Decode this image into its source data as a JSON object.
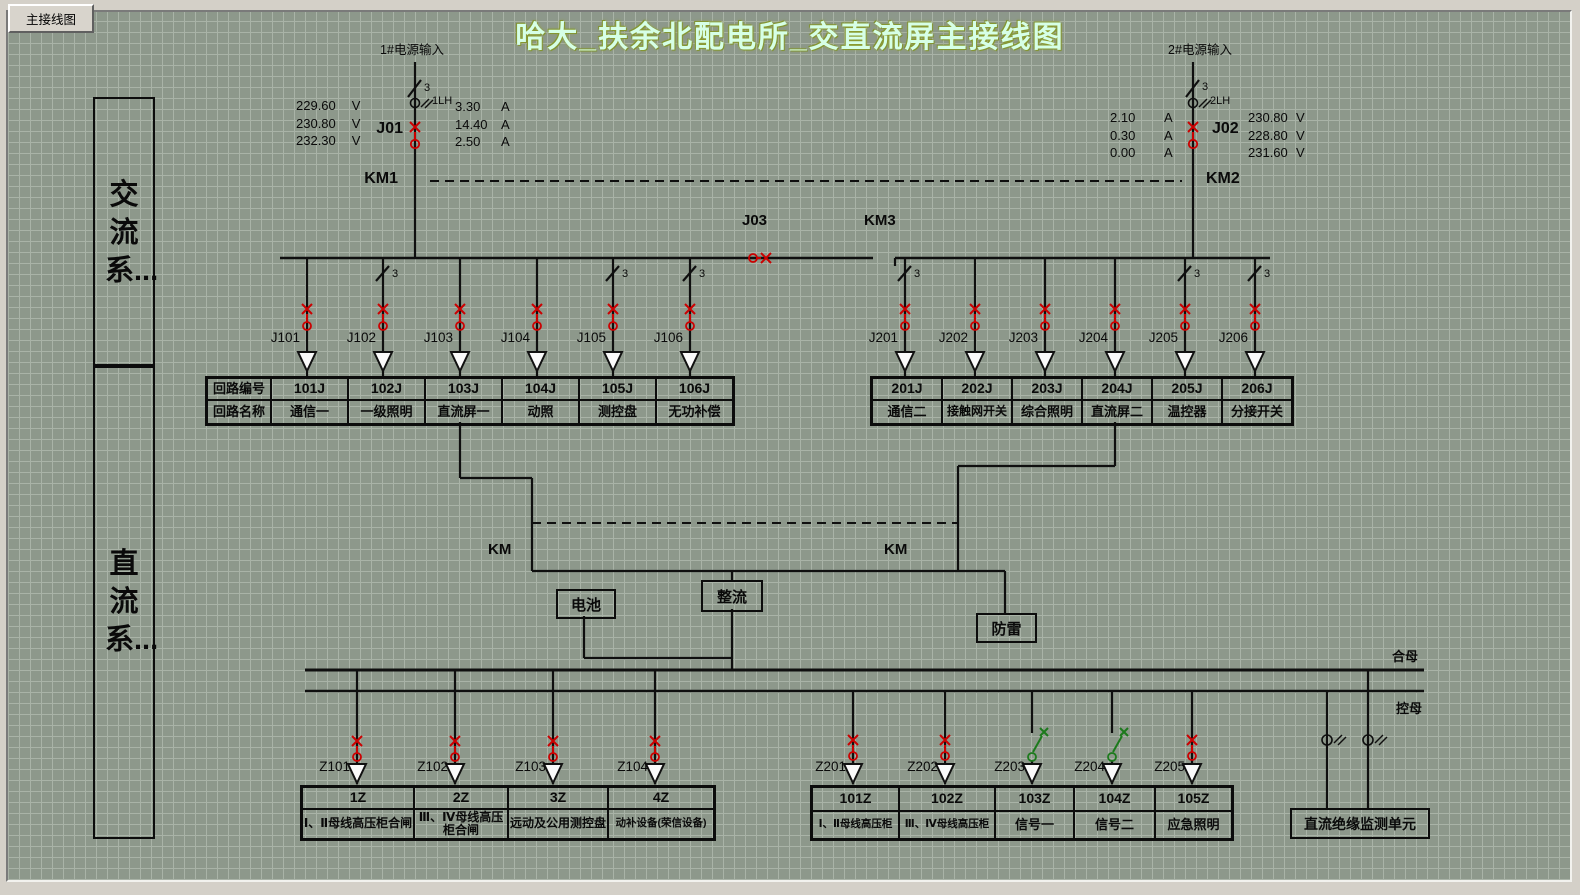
{
  "window": {
    "tab": "主接线图",
    "title": "哈大_扶余北配电所_交直流屏主接线图"
  },
  "side": {
    "ac": "交流系...",
    "dc": "直流系..."
  },
  "symbols": {
    "phase": "3"
  },
  "source1": {
    "label": "1#电源输入",
    "ct": "1LH",
    "breaker": "J01",
    "contactor": "KM1",
    "voltages": [
      "229.60",
      "230.80",
      "232.30"
    ],
    "vu": "V",
    "currents": [
      "3.30",
      "14.40",
      "2.50"
    ],
    "au": "A"
  },
  "source2": {
    "label": "2#电源输入",
    "ct": "2LH",
    "breaker": "J02",
    "contactor": "KM2",
    "currents": [
      "2.10",
      "0.30",
      "0.00"
    ],
    "au": "A",
    "voltages": [
      "230.80",
      "228.80",
      "231.60"
    ],
    "vu": "V"
  },
  "tie": {
    "breaker": "J03",
    "contactor": "KM3"
  },
  "ac_left": {
    "row_headers": [
      "回路编号",
      "回路名称"
    ],
    "feeders": [
      {
        "id": "J101",
        "code": "101J",
        "name": "通信一"
      },
      {
        "id": "J102",
        "code": "102J",
        "name": "一级照明"
      },
      {
        "id": "J103",
        "code": "103J",
        "name": "直流屏一"
      },
      {
        "id": "J104",
        "code": "104J",
        "name": "动照"
      },
      {
        "id": "J105",
        "code": "105J",
        "name": "测控盘"
      },
      {
        "id": "J106",
        "code": "106J",
        "name": "无功补偿"
      }
    ]
  },
  "ac_right": {
    "feeders": [
      {
        "id": "J201",
        "code": "201J",
        "name": "通信二"
      },
      {
        "id": "J202",
        "code": "202J",
        "name": "接触网开关"
      },
      {
        "id": "J203",
        "code": "203J",
        "name": "综合照明"
      },
      {
        "id": "J204",
        "code": "204J",
        "name": "直流屏二"
      },
      {
        "id": "J205",
        "code": "205J",
        "name": "温控器"
      },
      {
        "id": "J206",
        "code": "206J",
        "name": "分接开关"
      }
    ]
  },
  "dc": {
    "km_left": "KM",
    "km_right": "KM",
    "battery": "电池",
    "rectifier": "整流",
    "arrester": "防雷",
    "bus_close": "合母",
    "bus_control": "控母",
    "monitor": "直流绝缘监测单元"
  },
  "dc_left": {
    "feeders": [
      {
        "id": "Z101",
        "code": "1Z",
        "name": "Ⅰ、Ⅱ母线高压柜合闸"
      },
      {
        "id": "Z102",
        "code": "2Z",
        "name": "Ⅲ、Ⅳ母线高压柜合闸"
      },
      {
        "id": "Z103",
        "code": "3Z",
        "name": "远动及公用测控盘"
      },
      {
        "id": "Z104",
        "code": "4Z",
        "name": "动补设备(荣信设备)"
      }
    ]
  },
  "dc_right": {
    "feeders": [
      {
        "id": "Z201",
        "code": "101Z",
        "name": "Ⅰ、Ⅱ母线高压柜",
        "state": "closed"
      },
      {
        "id": "Z202",
        "code": "102Z",
        "name": "Ⅲ、Ⅳ母线高压柜",
        "state": "closed"
      },
      {
        "id": "Z203",
        "code": "103Z",
        "name": "信号一",
        "state": "open"
      },
      {
        "id": "Z204",
        "code": "104Z",
        "name": "信号二",
        "state": "open"
      },
      {
        "id": "Z205",
        "code": "105Z",
        "name": "应急照明",
        "state": "closed"
      }
    ]
  },
  "colors": {
    "closed": "#cc0000",
    "open": "#1c7a1c",
    "title": "#d6ffe6"
  }
}
